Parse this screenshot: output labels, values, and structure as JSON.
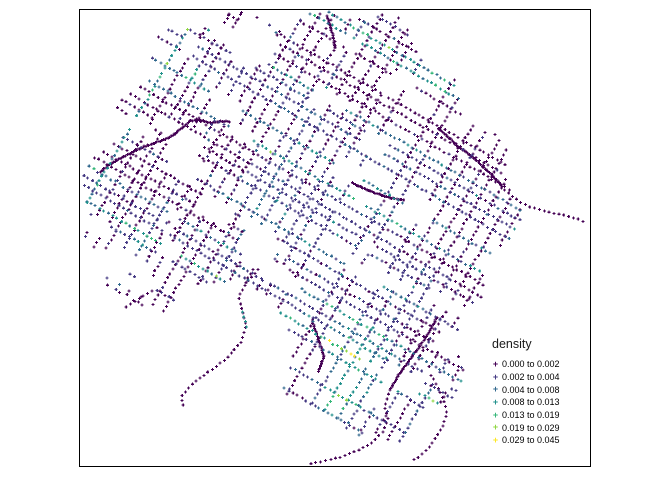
{
  "figure": {
    "width": 672,
    "height": 480,
    "background": "#ffffff"
  },
  "plot_box": {
    "left": 79,
    "top": 9,
    "width": 512,
    "height": 458,
    "border_color": "#000000"
  },
  "legend": {
    "title": "density",
    "items": [
      {
        "label": "0.000 to 0.002",
        "color": "#440154"
      },
      {
        "label": "0.002 to 0.004",
        "color": "#443983"
      },
      {
        "label": "0.004 to 0.008",
        "color": "#31688e"
      },
      {
        "label": "0.008 to 0.013",
        "color": "#21918c"
      },
      {
        "label": "0.013 to 0.019",
        "color": "#35b779"
      },
      {
        "label": "0.019 to 0.029",
        "color": "#90d743"
      },
      {
        "label": "0.029 to 0.045",
        "color": "#fde725"
      }
    ]
  },
  "map": {
    "marker_glyph": "+",
    "marker_arm": 1.5,
    "stroke_width": 1.1,
    "palette": [
      "#440154",
      "#443983",
      "#31688e",
      "#21918c",
      "#35b779",
      "#90d743",
      "#fde725"
    ],
    "generation": {
      "seed": 1337,
      "center": [
        295,
        212
      ],
      "angle_deg": 30,
      "street_spacing": 10.5,
      "cross_spacing": 13.5,
      "point_spacing": 5,
      "street_skip": 0.1,
      "cross_skip": 0.14,
      "clip": [
        81,
        11,
        590,
        466
      ],
      "radius_deg_start": -180,
      "radius_deg_step": 15,
      "radius_values": [
        203,
        206,
        210,
        212,
        206,
        200,
        200,
        208,
        202,
        206,
        210,
        212,
        215,
        208,
        205,
        222,
        242,
        248,
        185,
        165,
        162,
        170,
        188,
        198
      ],
      "edge_wobble": [
        [
          0.11,
          2.1,
          0.045
        ],
        [
          0.29,
          0.7,
          0.04
        ]
      ],
      "voids": [
        [
          222,
          352,
          70
        ],
        [
          98,
          28,
          42
        ],
        [
          252,
          42,
          24
        ]
      ],
      "gap_count": 80,
      "gap_size": [
        8,
        38,
        5,
        20
      ],
      "street_bias_weights": [
        0.56,
        0.2,
        0.14,
        0.1
      ],
      "cross_bias_weights": [
        0.68,
        0.16,
        0.1,
        0.06
      ],
      "hotspots": [
        [
          340,
          225,
          115,
          1.6
        ],
        [
          360,
          345,
          55,
          2.2
        ],
        [
          352,
          390,
          55,
          3.0
        ],
        [
          333,
          404,
          22,
          4.2
        ],
        [
          195,
          74,
          15,
          3.8
        ],
        [
          110,
          273,
          14,
          3.8
        ],
        [
          130,
          250,
          28,
          1.6
        ],
        [
          300,
          95,
          45,
          1.1
        ],
        [
          420,
          295,
          50,
          1.4
        ],
        [
          260,
          190,
          60,
          1.2
        ]
      ],
      "road_spacing": 1.7,
      "roads": [
        [
          [
            100,
            172
          ],
          [
            112,
            163
          ],
          [
            126,
            155
          ],
          [
            143,
            147
          ],
          [
            160,
            141
          ],
          [
            172,
            136
          ],
          [
            182,
            128
          ],
          [
            190,
            121
          ],
          [
            200,
            120
          ],
          [
            210,
            123
          ],
          [
            221,
            121
          ],
          [
            231,
            122
          ]
        ],
        [
          [
            438,
            128
          ],
          [
            458,
            146
          ],
          [
            476,
            160
          ],
          [
            492,
            175
          ],
          [
            503,
            187
          ]
        ],
        [
          [
            437,
            317
          ],
          [
            428,
            334
          ],
          [
            419,
            347
          ],
          [
            409,
            361
          ],
          [
            398,
            376
          ],
          [
            389,
            391
          ]
        ],
        [
          [
            327,
            16
          ],
          [
            332,
            32
          ],
          [
            335,
            48
          ]
        ],
        [
          [
            352,
            183
          ],
          [
            370,
            191
          ],
          [
            390,
            198
          ],
          [
            404,
            200
          ]
        ],
        [
          [
            312,
            320
          ],
          [
            318,
            338
          ],
          [
            324,
            356
          ],
          [
            318,
            372
          ]
        ]
      ],
      "trail_spacing": 5,
      "trails": [
        {
          "level": 0,
          "pts": [
            [
              505,
              190
            ],
            [
              514,
              198
            ],
            [
              524,
              204
            ],
            [
              536,
              209
            ],
            [
              549,
              212
            ],
            [
              563,
              215
            ],
            [
              577,
              219
            ],
            [
              584,
              222
            ]
          ]
        },
        {
          "level": 0,
          "pts": [
            [
              258,
              270
            ],
            [
              247,
              282
            ],
            [
              239,
              296
            ],
            [
              242,
              310
            ],
            [
              246,
              326
            ],
            [
              241,
              342
            ],
            [
              230,
              355
            ],
            [
              216,
              367
            ],
            [
              200,
              378
            ],
            [
              188,
              388
            ],
            [
              181,
              398
            ],
            [
              184,
              407
            ]
          ]
        },
        {
          "level": 0,
          "pts": [
            [
              152,
              291
            ],
            [
              138,
              299
            ],
            [
              125,
              308
            ]
          ]
        },
        {
          "level": 0,
          "pts": [
            [
              388,
              394
            ],
            [
              385,
              408
            ],
            [
              388,
              420
            ],
            [
              382,
              433
            ],
            [
              371,
              443
            ],
            [
              357,
              451
            ],
            [
              341,
              457
            ],
            [
              325,
              461
            ],
            [
              308,
              464
            ]
          ]
        },
        {
          "level": 0,
          "pts": [
            [
              431,
              375
            ],
            [
              438,
              388
            ],
            [
              444,
              401
            ],
            [
              447,
              413
            ],
            [
              443,
              425
            ],
            [
              436,
              437
            ],
            [
              429,
              447
            ],
            [
              420,
              456
            ],
            [
              410,
              462
            ]
          ]
        },
        {
          "level": 3,
          "pts": [
            [
              243,
              312
            ],
            [
              247,
              331
            ]
          ]
        }
      ]
    }
  }
}
